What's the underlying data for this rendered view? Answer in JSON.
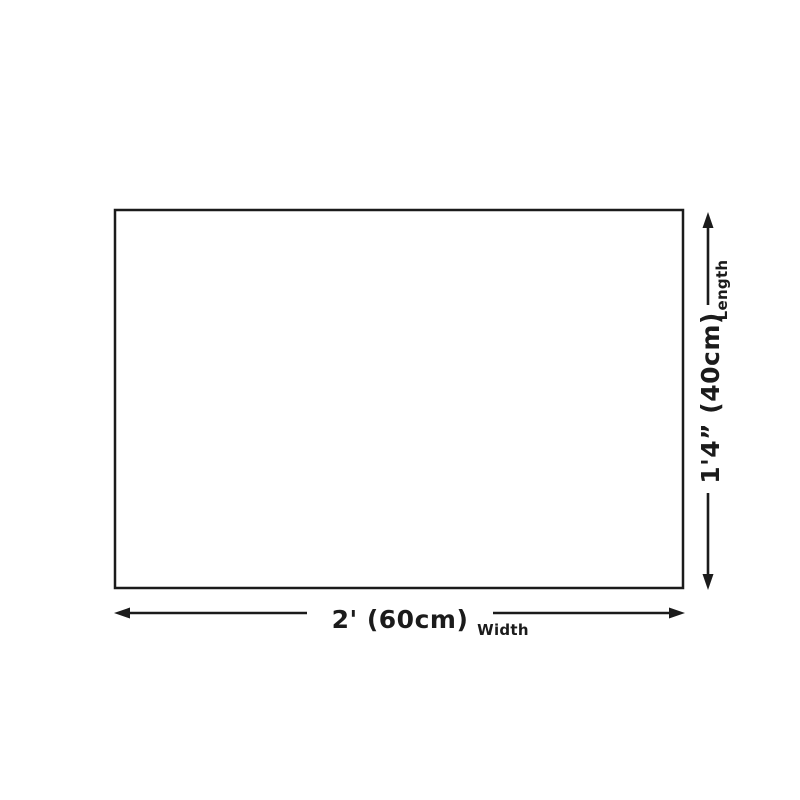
{
  "diagram": {
    "type": "product-dimension-diagram",
    "shape": "rectangle",
    "colors": {
      "line": "#1b1b1b",
      "background": "#ffffff",
      "rect_fill": "#ffffff"
    },
    "dimensions": {
      "width": {
        "value": "2' (60cm)",
        "label": "Width"
      },
      "length": {
        "value": "1'4” (40cm)",
        "label": "Length"
      }
    }
  }
}
